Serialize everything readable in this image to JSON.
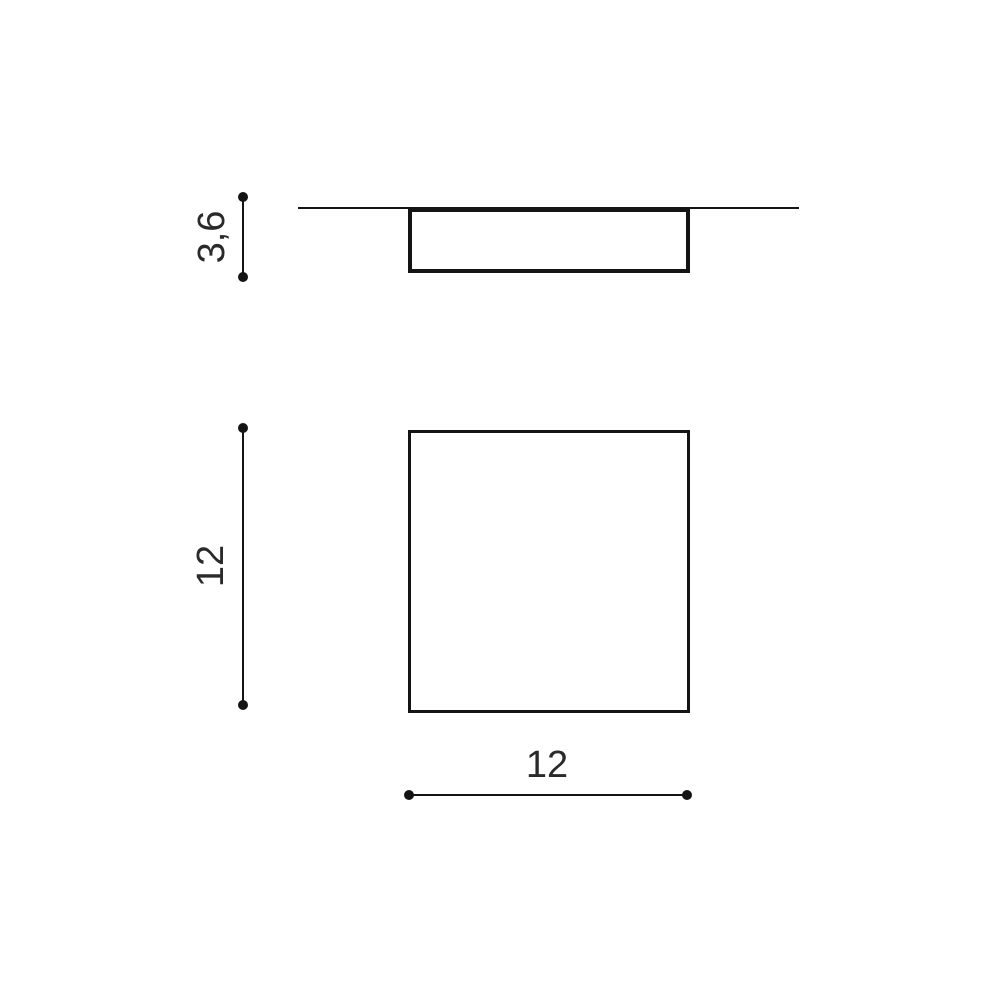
{
  "drawing": {
    "side_view": {
      "depth_dimension": "3,6"
    },
    "plan_view": {
      "height_dimension": "12",
      "width_dimension": "12"
    },
    "colors": {
      "line": "#141414",
      "text": "#2a2a2a",
      "background": "#ffffff"
    }
  }
}
